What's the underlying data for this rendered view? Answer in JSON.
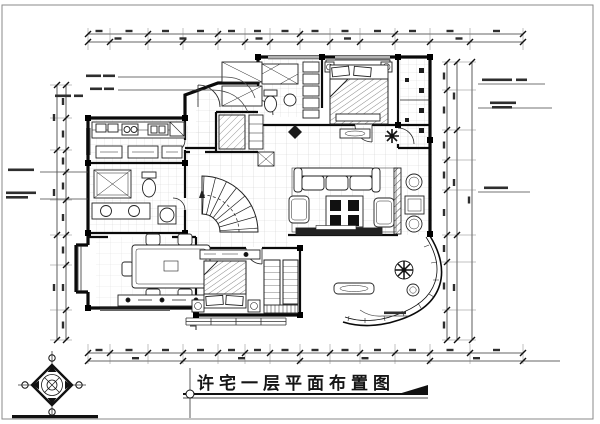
{
  "drawing": {
    "title": "许宅一层平面布置图",
    "kind": "residential first-floor furniture layout plan (CAD)",
    "floor_label": "一层"
  },
  "symbols": {
    "north_indicator": "compass-rose-icon",
    "title_marker_left": "axis-circle-icon",
    "title_marker_right": "solid-triangle-icon"
  },
  "depicted_rooms": [
    "kitchen",
    "bathroom-1",
    "dining-room",
    "entry-hall",
    "staircase",
    "master-bedroom",
    "ensuite-bathroom",
    "closet",
    "bathroom-top-right",
    "corridor",
    "living-room",
    "bedroom-2",
    "balcony",
    "bay-window"
  ],
  "depicted_furniture": [
    "double-bed",
    "pillows",
    "nightstands",
    "wardrobe",
    "sofa-set",
    "coffee-table",
    "tv-cabinet",
    "dining-table-six-chairs",
    "sideboard",
    "bathtub",
    "shower",
    "toilet",
    "twin-basins",
    "kitchen-counter",
    "cooktop",
    "sink",
    "round-table",
    "stool",
    "potted-plants",
    "console-table",
    "bench"
  ],
  "colors": {
    "background": "#ffffff",
    "wall": "#0a0a0a",
    "line": "#222222",
    "tile_grid": "#cccccc",
    "annotation": "#3c3c3c",
    "border": "#8a8a8a"
  }
}
